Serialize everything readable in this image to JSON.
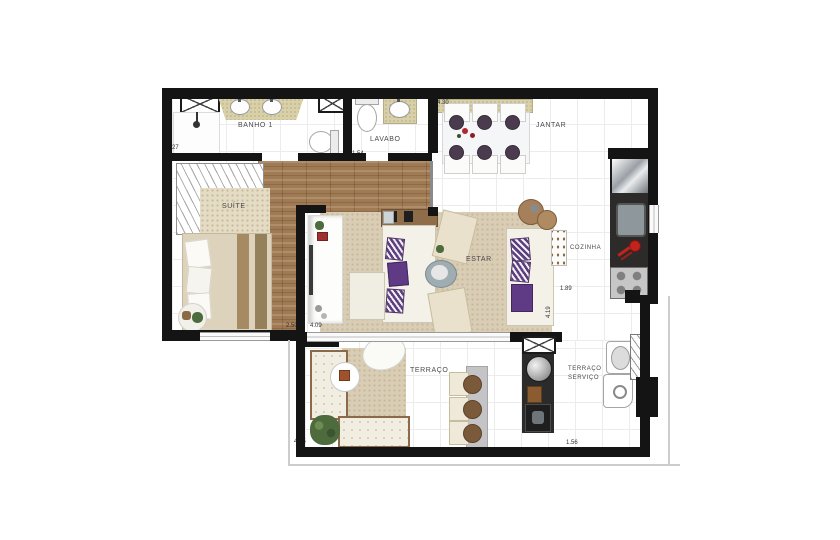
{
  "plan_type": "apartment-floor-plan",
  "rooms": {
    "banho1": "BANHO 1",
    "lavabo": "LAVABO",
    "jantar": "JANTAR",
    "suite": "SUÍTE",
    "estar": "ESTAR",
    "cozinha": "COZINHA",
    "terraco": "TERRAÇO",
    "terraco_servico_l1": "TERRAÇO",
    "terraco_servico_l2": "SERVIÇO"
  },
  "dims": {
    "banho": "3.27",
    "lavabo": "1.54",
    "jantar": "4.30",
    "suite": "2.50",
    "estar": "4.09",
    "estar_depth": "4.19",
    "cozinha": "1.89",
    "terraco": "4.55",
    "servico": "1.56"
  },
  "icons": {
    "shaft_cross": "✕",
    "shower_head": "shower",
    "sink": "oval-basin",
    "stove_burners": "4-circles"
  },
  "colors": {
    "wall": "#141414",
    "wood_floor": "#a07a52",
    "rug_beige": "#dacdb5",
    "granite_counter": "#d8d0a8",
    "kitchen_counter_dark": "#2d2b29",
    "pillow_purple": "#5f3b85",
    "accent_red": "#c0241c",
    "slab_edge": "#cccccc"
  }
}
